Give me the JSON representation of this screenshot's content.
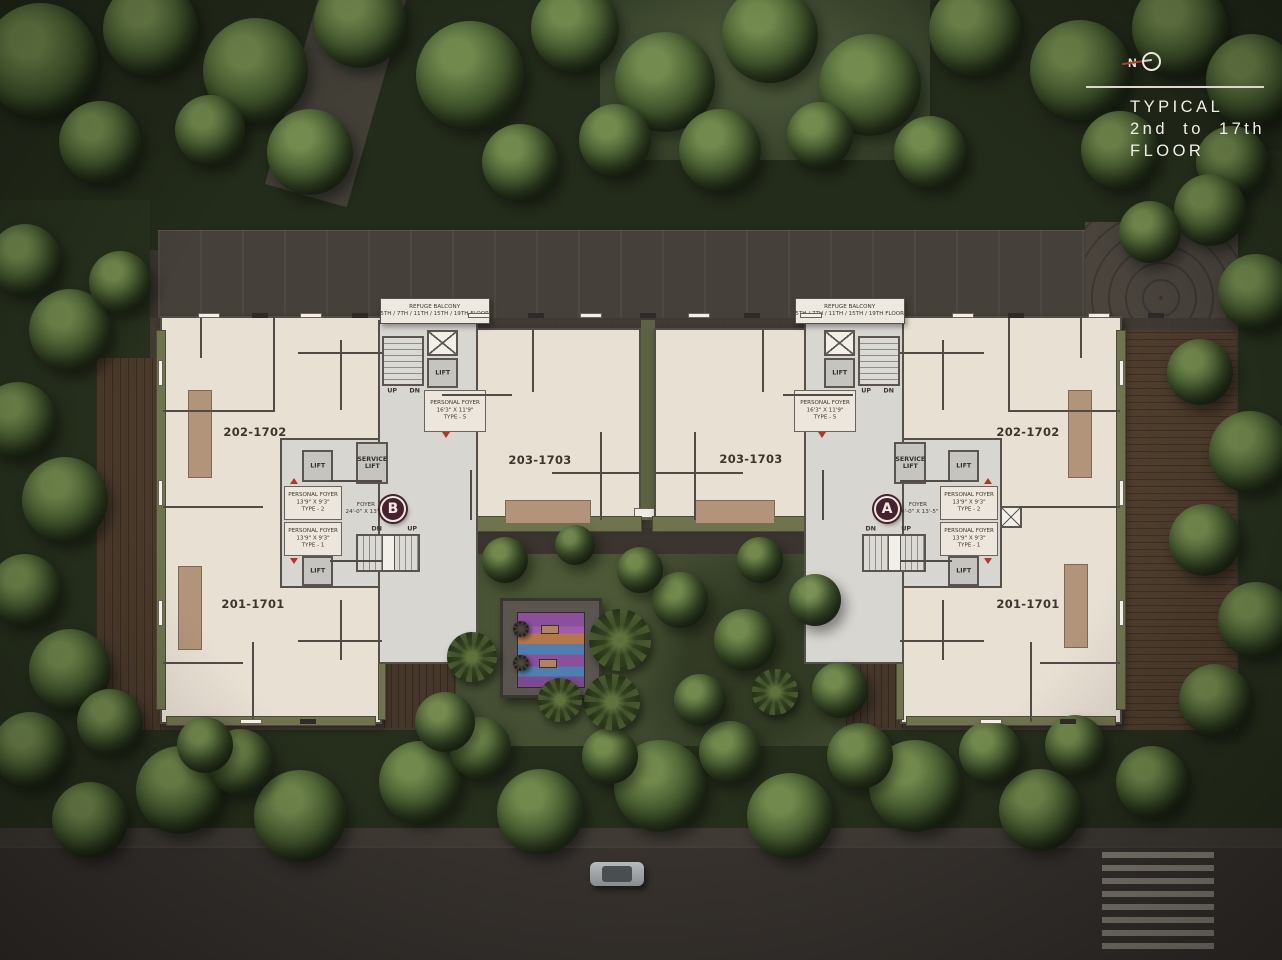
{
  "legend": {
    "north_label": "N",
    "title_line1": "TYPICAL",
    "title_line2": "2nd to 17th",
    "title_line3": "FLOOR"
  },
  "plan": {
    "refuge_balcony": {
      "line1": "REFUGE BALCONY",
      "line2": "5TH / 7TH / 11TH / 15TH / 19TH FLOOR"
    },
    "lift_label": "LIFT",
    "service_lift_line1": "SERVICE",
    "service_lift_line2": "LIFT",
    "up_label": "UP",
    "dn_label": "DN",
    "foyer": {
      "line1": "FOYER",
      "line2": "24'-0\" X 13'-5\""
    },
    "personal_foyer_type5": {
      "line1": "PERSONAL FOYER",
      "line2": "16'3\" X 11'9\"",
      "line3": "TYPE - 5"
    },
    "personal_foyer_type2": {
      "line1": "PERSONAL FOYER",
      "line2": "13'9\" X 9'3\"",
      "line3": "TYPE - 2"
    },
    "personal_foyer_type1": {
      "line1": "PERSONAL FOYER",
      "line2": "13'9\" X 9'3\"",
      "line3": "TYPE - 1"
    },
    "tower_b_badge": "B",
    "tower_a_badge": "A",
    "units": {
      "b_top": "202-1702",
      "b_bottom": "201-1701",
      "b_center": "203-1703",
      "a_center": "203-1703",
      "a_top": "202-1702",
      "a_bottom": "201-1701"
    }
  },
  "colors": {
    "plan_fill": "#e8e0d3",
    "core_fill": "#d8d6d1",
    "wall": "#514c45",
    "balcony_olive": "#70744e",
    "deck_tan": "#b2947a",
    "badge_maroon": "#45222d",
    "accent_red": "#b5342a",
    "title_text": "#f2efe9"
  }
}
